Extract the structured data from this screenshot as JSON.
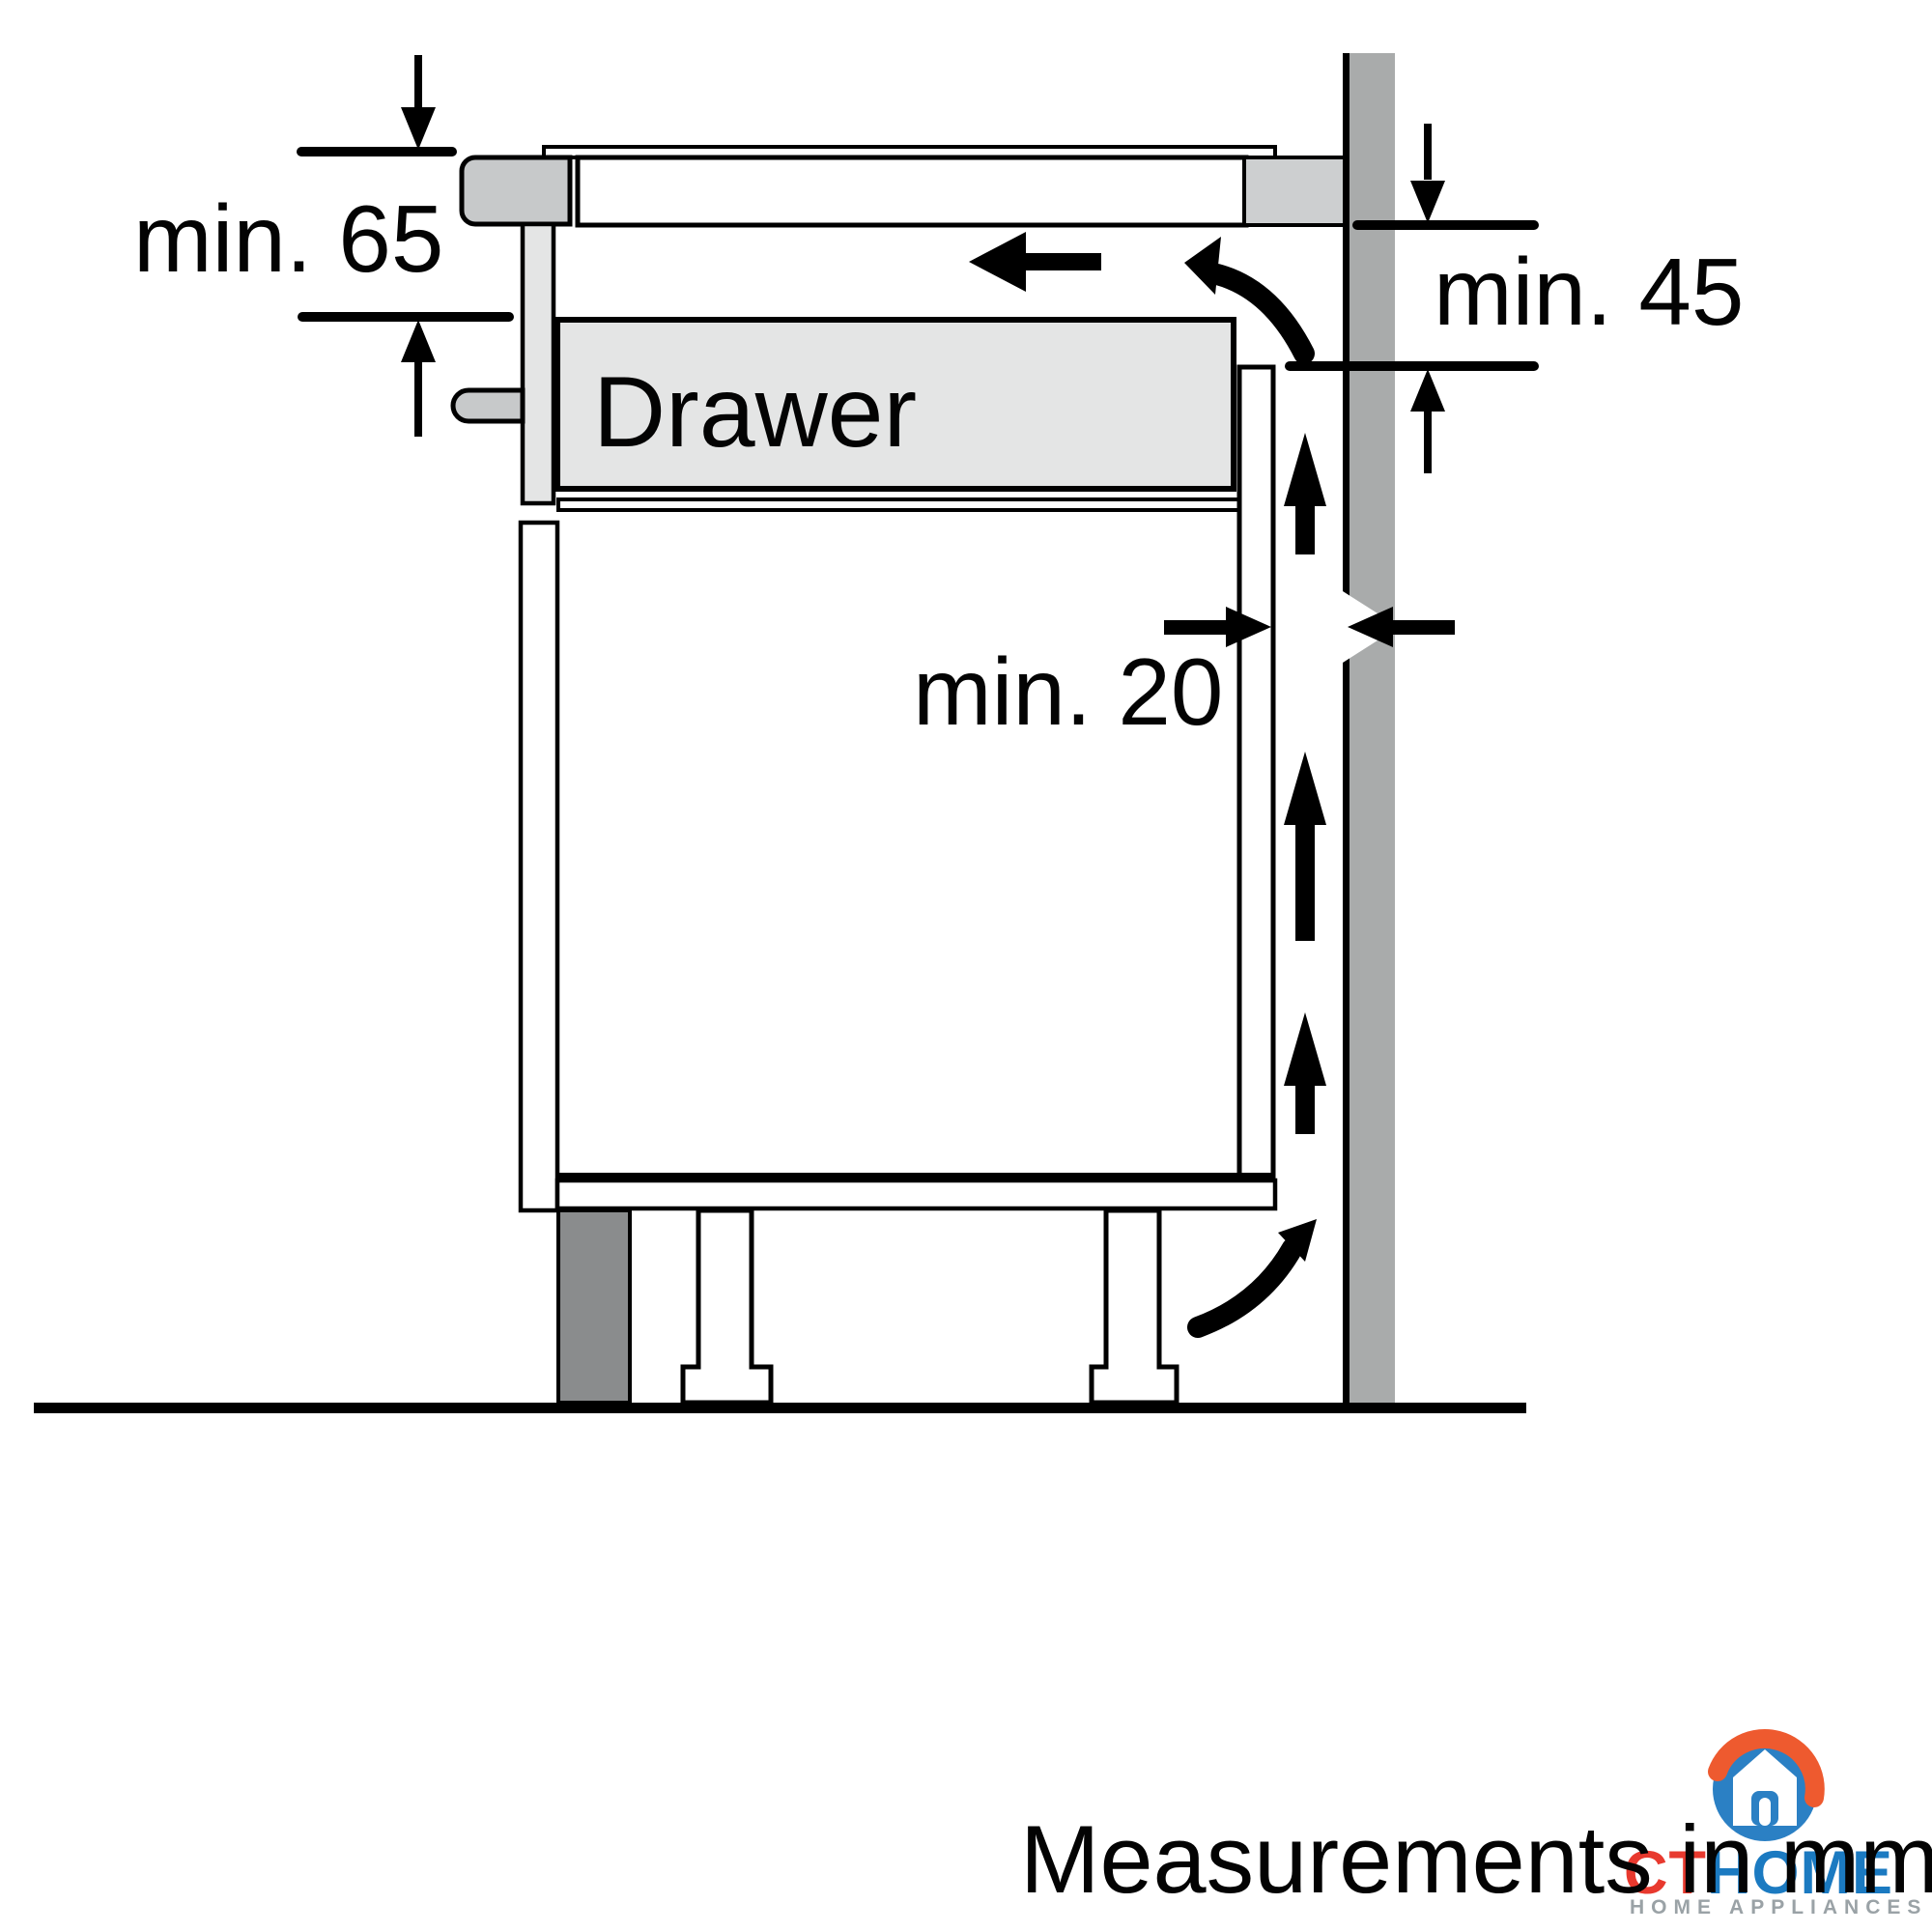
{
  "labels": {
    "dim_top_left": "min. 65",
    "dim_right": "min. 45",
    "dim_gap": "min. 20",
    "drawer": "Drawer",
    "footer": "Measurements in mm"
  },
  "logo": {
    "brand_red": "CT",
    "brand_blue": "HOME",
    "tagline": "HOME APPLIANCES"
  },
  "dimensions_mm": {
    "clearance_below_worktop": "min. 65",
    "clearance_behind_to_wall_top": "min. 45",
    "ventilation_gap_back_panel": "min. 20"
  },
  "colors": {
    "line": "#000000",
    "wall": "#a9abab",
    "hob_hardware_gray": "#c7c9ca",
    "spacer_gray": "#cdcfd0",
    "drawer_gray": "#e4e5e5",
    "plinth_gray": "#8a8c8d",
    "logo_red": "#e8392e",
    "logo_blue": "#1b7ac1",
    "logo_swirl_blue": "#2b80c4",
    "logo_swirl_orange": "#ee5a2f",
    "logo_tagline_gray": "#9aa2a6"
  }
}
